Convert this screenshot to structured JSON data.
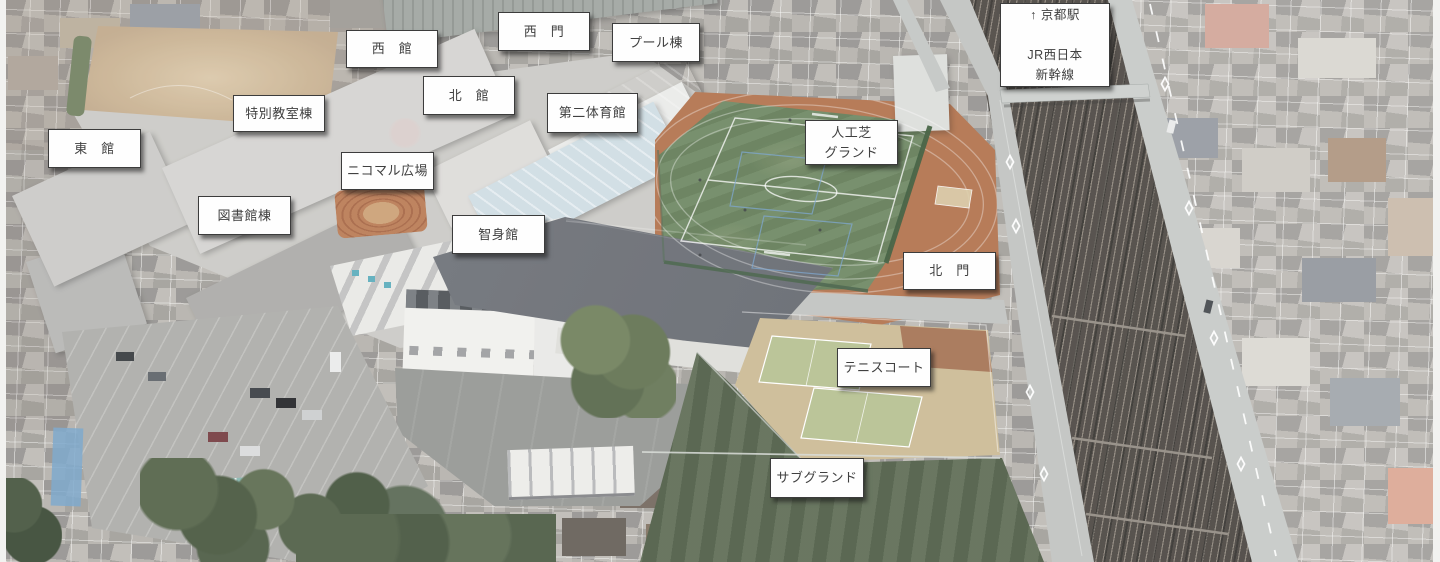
{
  "scene": {
    "type": "campus-aerial-photo",
    "colors": {
      "turf_field": "#5e7a51",
      "running_track": "#ad6a42",
      "pool_roof": "#2d93ad",
      "gymnasium_roof": "#5f636b",
      "tennis_sand": "#c9b78f",
      "tennis_court": "#b2be8b",
      "sub_ground": "#4b5b41",
      "dirt_field": "#cbb494",
      "railway": "#4a443e",
      "label_background": "#fefefe",
      "label_border": "#3c3c3c",
      "label_text": "#404040"
    }
  },
  "labels": [
    {
      "id": "west-building",
      "text": "西　館"
    },
    {
      "id": "west-gate",
      "text": "西　門"
    },
    {
      "id": "pool-building",
      "text": "プール棟"
    },
    {
      "id": "north-building",
      "text": "北　館"
    },
    {
      "id": "special-classroom-building",
      "text": "特別教室棟"
    },
    {
      "id": "second-gymnasium",
      "text": "第二体育館"
    },
    {
      "id": "east-building",
      "text": "東　館"
    },
    {
      "id": "artificial-turf-ground",
      "text": "人工芝\nグランド"
    },
    {
      "id": "kyoto-station-direction",
      "text": "↑ 京都駅\n\nJR西日本\n新幹線"
    },
    {
      "id": "nicomaru-plaza",
      "text": "ニコマル広場"
    },
    {
      "id": "library-building",
      "text": "図書館棟"
    },
    {
      "id": "chishinkan",
      "text": "智身館"
    },
    {
      "id": "north-gate",
      "text": "北　門"
    },
    {
      "id": "tennis-court",
      "text": "テニスコート"
    },
    {
      "id": "sub-ground",
      "text": "サブグランド"
    }
  ]
}
